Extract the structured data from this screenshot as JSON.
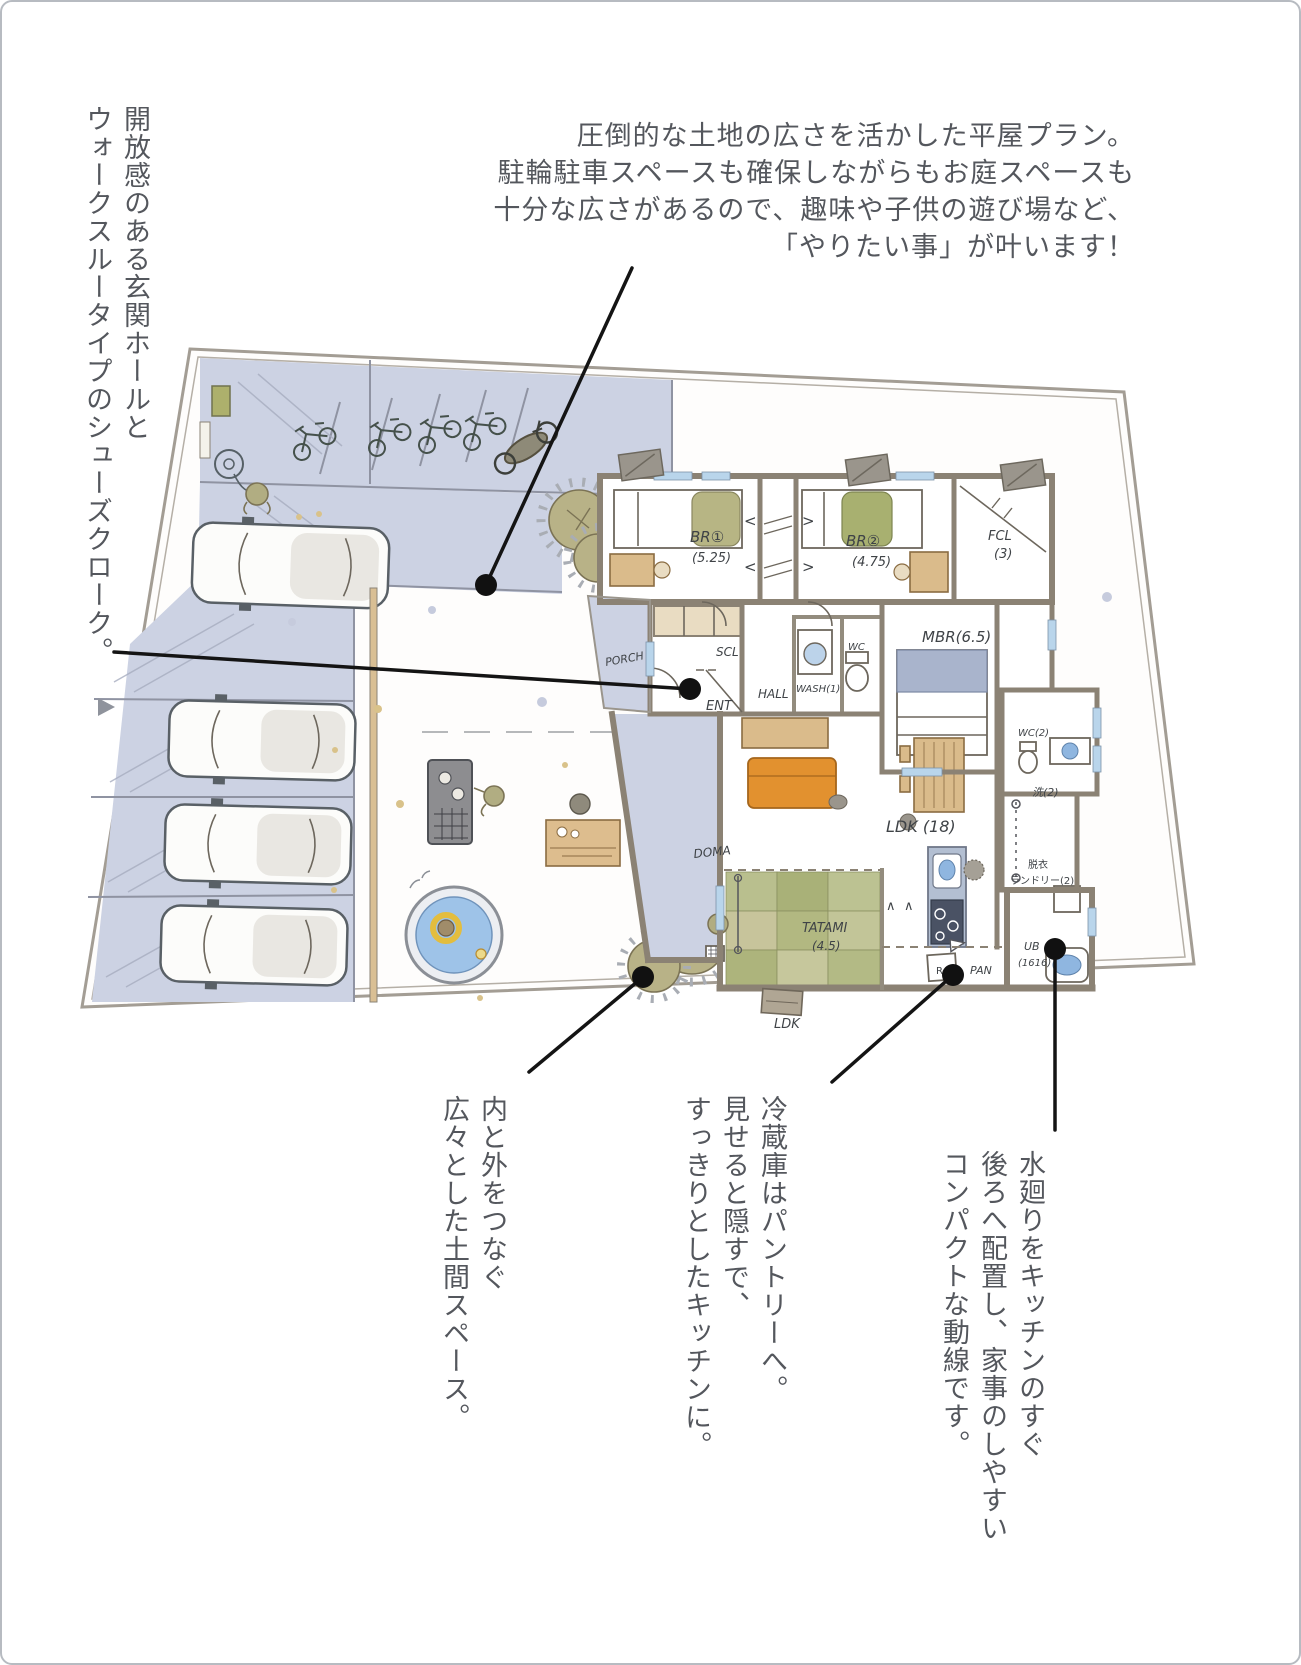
{
  "page": {
    "background": "#ffffff",
    "border_color": "#b7bbc1",
    "ink_color": "#54575d"
  },
  "annotations": {
    "top_right": {
      "lines": [
        "圧倒的な土地の広さを活かした平屋プラン。",
        "駐輪駐車スペースも確保しながらもお庭スペースも",
        "十分な広さがあるので、趣味や子供の遊び場など、",
        "「やりたい事」が叶います！"
      ]
    },
    "left_vertical": {
      "lines": [
        "開放感のある玄関ホールと",
        "ウォークスルータイプのシューズクローク。"
      ]
    },
    "bottom_doma": {
      "lines": [
        "内と外をつなぐ",
        "広々とした土間スペース。"
      ]
    },
    "bottom_fridge": {
      "lines": [
        "冷蔵庫はパントリーへ。",
        "見せると隠すで、",
        "すっきりとしたキッチンに。"
      ]
    },
    "bottom_water": {
      "lines": [
        "水廻りをキッチンのすぐ",
        "後ろへ配置し、家事のしやすい",
        "コンパクトな動線です。"
      ]
    }
  },
  "plan": {
    "labels": {
      "br1": "BR①",
      "br1_size": "(5.25)",
      "br2": "BR②",
      "br2_size": "(4.75)",
      "fcl": "FCL",
      "fcl_size": "(3)",
      "mbr": "MBR(6.5)",
      "scl": "SCL",
      "ent": "ENT",
      "hall": "HALL",
      "porch": "PORCH",
      "wash": "WASH(1)",
      "wc": "WC",
      "wc2": "WC(2)",
      "sen2": "洗(2)",
      "ldk": "LDK (18)",
      "doma": "DOMA",
      "tatami": "TATAMI",
      "tatami_size": "(4.5)",
      "datsui": "脱衣",
      "laundry": "ランドリー(2)",
      "ub": "UB",
      "ub_size": "(1616)",
      "fridge": "R",
      "pantry": "PAN",
      "deck": "LDK",
      "chevron_left": "<",
      "chevron_right": ">",
      "caret": "∧"
    },
    "colors": {
      "pavement": "#ccd2e3",
      "wall_gray": "#8b8274",
      "tatami_green": "#b7bd8b",
      "wood_tan": "#dabb8b",
      "sofa_orange": "#e2912f",
      "water_blue": "#9ec3e8",
      "tree_olive": "#b8b287",
      "leader_black": "#141414"
    }
  }
}
